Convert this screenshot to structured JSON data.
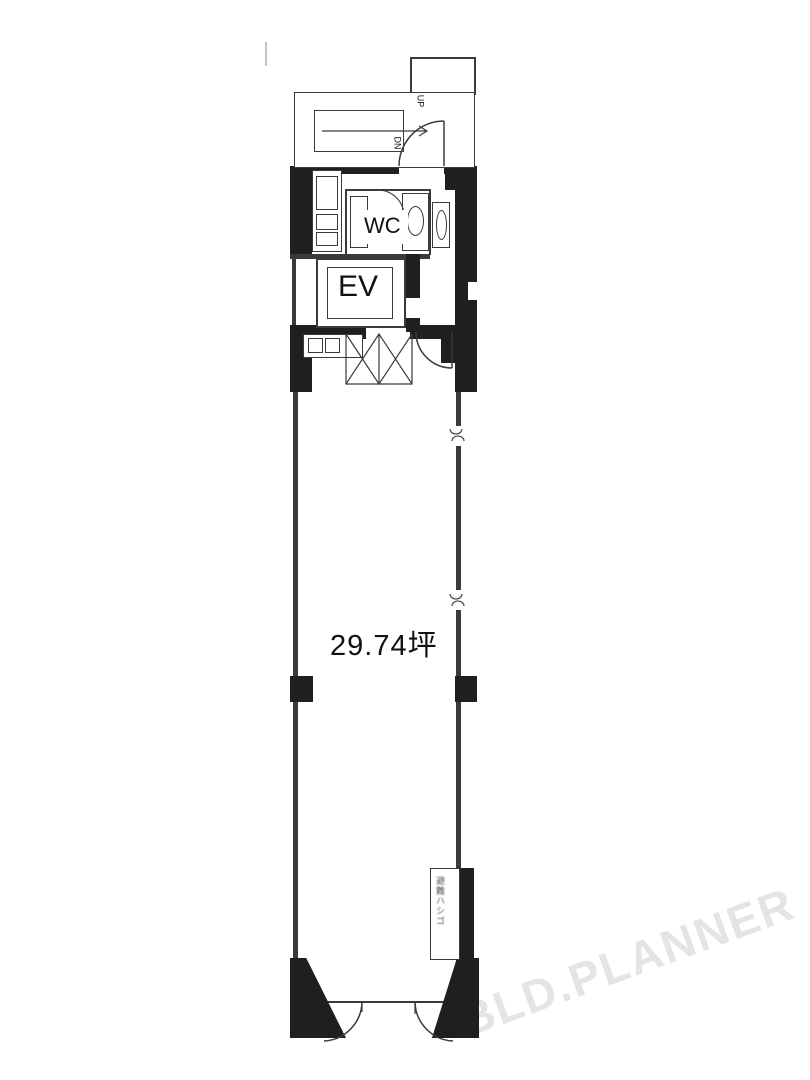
{
  "plan": {
    "title": "floor-plan",
    "area_label": "29.74坪",
    "elevator_label": "EV",
    "toilet_label": "WC",
    "stairs": {
      "up_label": "UP",
      "down_label": "DN"
    },
    "hatch_label": "避難ハシゴ",
    "watermark": "BLD.PLANNER",
    "colors": {
      "wall": "#1f1f1f",
      "line": "#3a3a3a",
      "watermark": "#e4e4e4",
      "background": "#ffffff"
    }
  }
}
